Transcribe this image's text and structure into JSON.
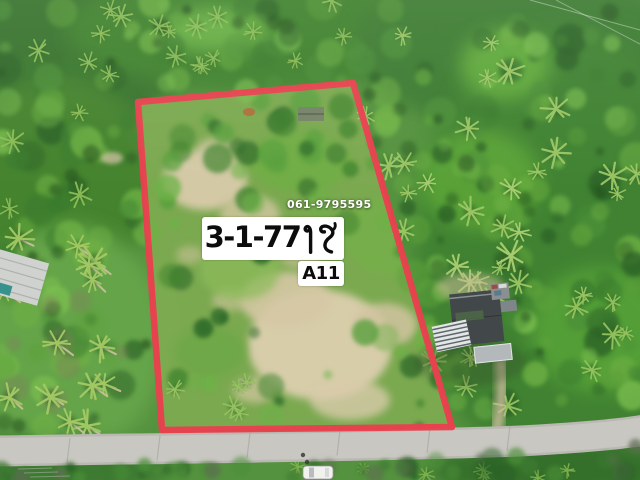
{
  "overlay": {
    "phone_number": "061-9795595",
    "area_label": "3-1-77 ไร่",
    "area_number": "3-1-77",
    "area_unit": "ไร่",
    "plot_code": "A11"
  },
  "boundary": {
    "points": [
      [
        138,
        102
      ],
      [
        353,
        83
      ],
      [
        452,
        427
      ],
      [
        162,
        430
      ]
    ],
    "stroke_width": 6.5
  },
  "colors": {
    "boundary_red": "#e9404e",
    "label_bg": "#ffffff",
    "label_text": "#0c0c0c",
    "phone_text": "#ffffff",
    "canopy_dark": "#2b6127",
    "canopy_mid": "#417f30",
    "canopy_bright": "#5da23b",
    "palm_frond": "#a4c964",
    "grass": "#65a449",
    "scrub": "#7dab51",
    "sand": "#d9cbaa",
    "road": "#c8c7c1",
    "roof_dark": "#42474a",
    "roof_light": "#b3b8ba",
    "car_white": "#f1f1ee",
    "teal_accent": "#37918c"
  }
}
